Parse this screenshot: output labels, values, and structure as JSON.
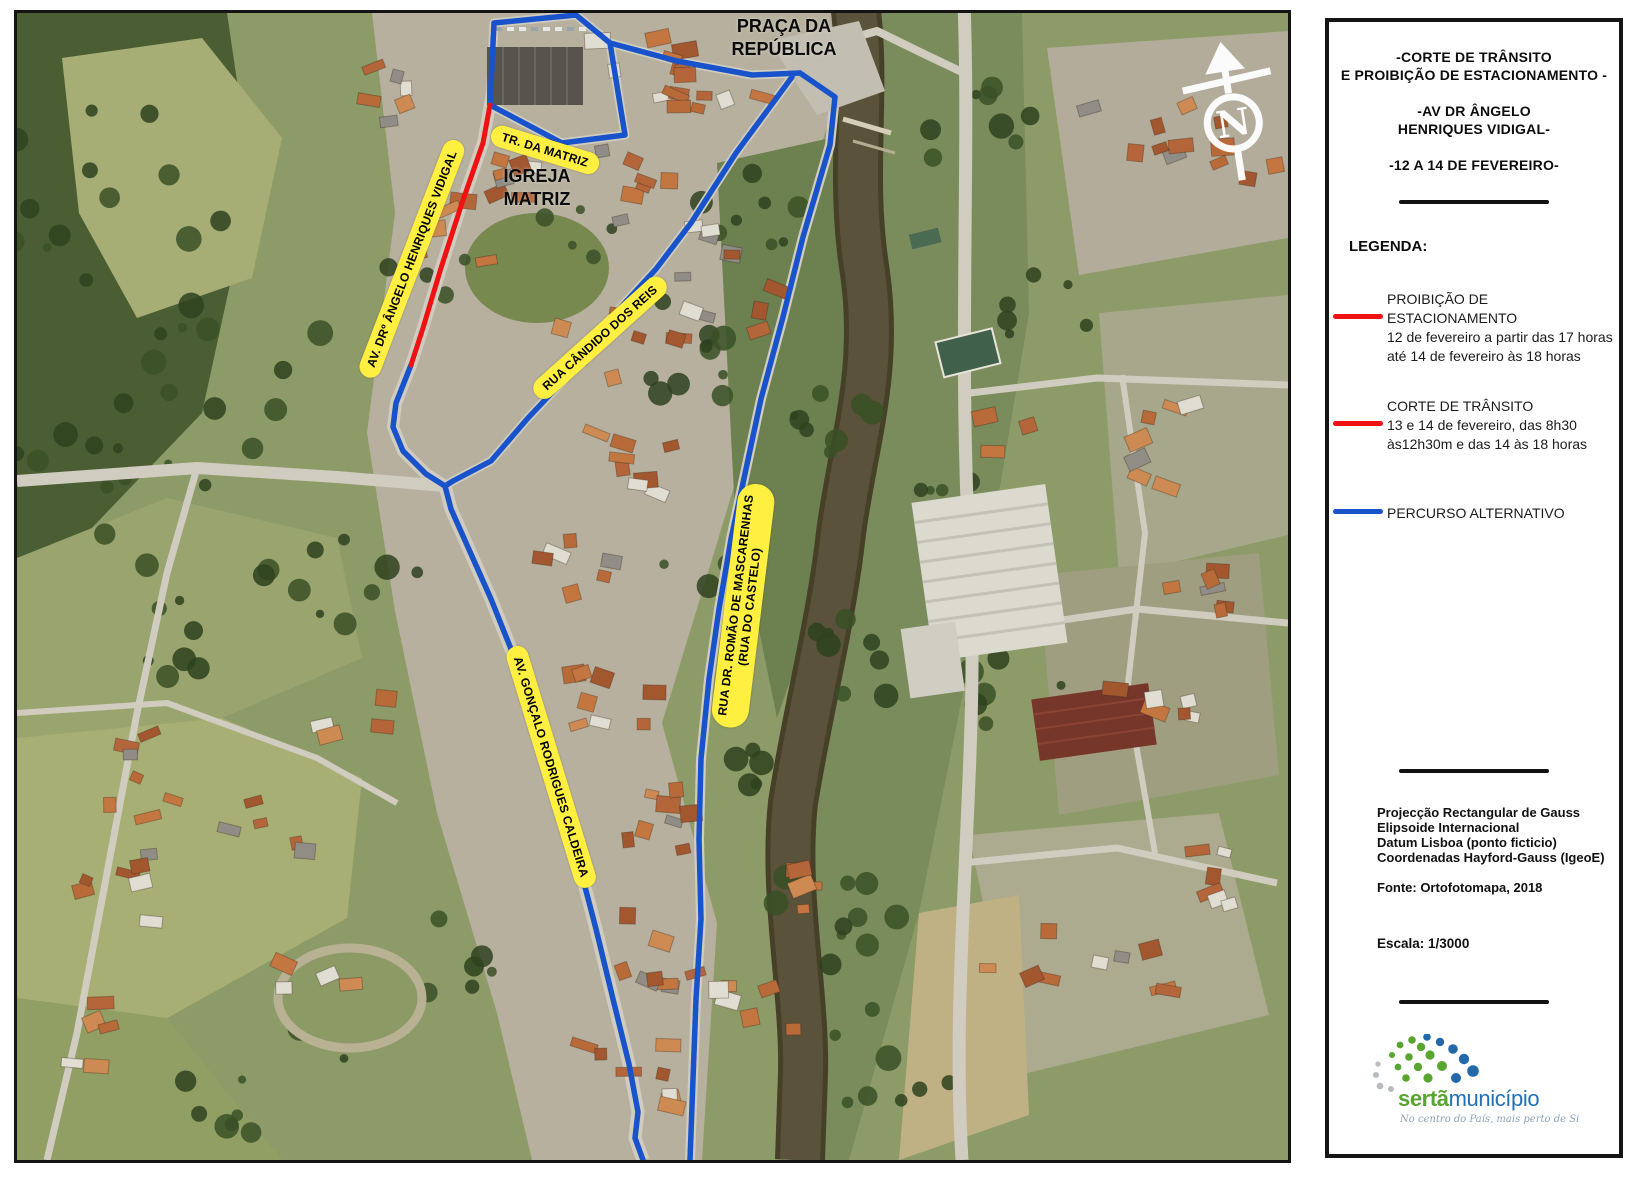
{
  "colors": {
    "route_blue": "#1853cc",
    "route_red": "#f01212",
    "label_yellow": "#ffef40",
    "logo_green": "#58a52f",
    "logo_blue": "#2272b5"
  },
  "map": {
    "street_labels": [
      {
        "text": "TR. DA MATRIZ"
      },
      {
        "text": "AV. DRº ÂNGELO HENRIQUES VIDIGAL"
      },
      {
        "text": "RUA CÂNDIDO DOS REIS"
      },
      {
        "text": "RUA DR. ROMÃO DE MASCARENHAS\n(RUA DO CASTELO)"
      },
      {
        "text": "AV. GONÇALO RODRIGUES CALDEIRA"
      }
    ],
    "place_labels": [
      {
        "text": "PRAÇA DA\nREPÚBLICA"
      },
      {
        "text": "IGREJA\nMATRIZ"
      }
    ],
    "north_label": "N"
  },
  "panel": {
    "title": "-CORTE DE TRÂNSITO\nE PROIBIÇÃO DE ESTACIONAMENTO -\n\n-AV DR ÂNGELO\nHENRIQUES VIDIGAL-\n\n-12 A 14 DE FEVEREIRO-",
    "legend_heading": "LEGENDA:",
    "legend": [
      {
        "swatch": "#f01212",
        "text": "PROIBIÇÃO DE ESTACIONAMENTO\n12 de fevereiro a partir das 17 horas\naté 14 de fevereiro às 18 horas"
      },
      {
        "swatch": "#f01212",
        "text": "CORTE DE TRÂNSITO\n13 e 14 de fevereiro, das 8h30\nàs12h30m e das 14 às 18 horas"
      },
      {
        "swatch": "#1853cc",
        "text": "PERCURSO ALTERNATIVO"
      }
    ],
    "projection_info": "Projecção Rectangular de Gauss\nElipsoide Internacional\nDatum Lisboa (ponto ficticio)\nCoordenadas Hayford-Gauss (IgeoE)",
    "source": "Fonte: Ortofotomapa, 2018",
    "scale": "Escala: 1/3000",
    "logo": {
      "name_bold": "sertã",
      "name_regular": "município",
      "tagline": "No centro do País, mais perto de Si"
    }
  }
}
